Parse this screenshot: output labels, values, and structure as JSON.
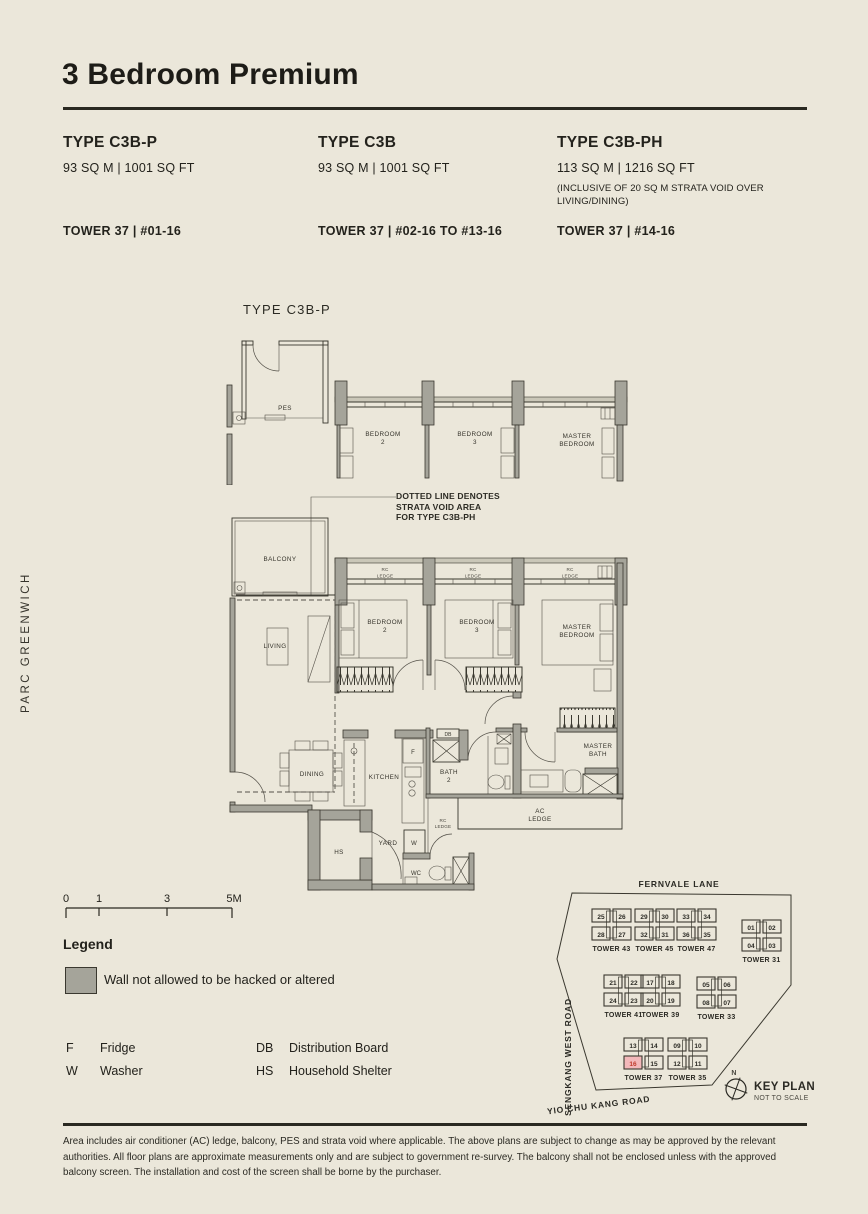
{
  "page": {
    "title": "3 Bedroom Premium",
    "brand_vertical": "PARC GREENWICH",
    "disclaimer": "Area includes air conditioner (AC) ledge, balcony, PES and strata void where applicable. The above plans are subject to change as may be approved by the relevant authorities. All floor plans are approximate measurements only and are subject to government re-survey. The balcony shall not be enclosed unless with the approved balcony screen. The installation and cost of the screen shall be borne by the purchaser."
  },
  "unit_types": [
    {
      "name": "TYPE C3B-P",
      "area": "93 SQ M | 1001 SQ FT",
      "note": "",
      "tower": "TOWER 37 | #01-16"
    },
    {
      "name": "TYPE C3B",
      "area": "93 SQ M | 1001 SQ FT",
      "note": "",
      "tower": "TOWER 37 | #02-16 TO #13-16"
    },
    {
      "name": "TYPE C3B-PH",
      "area": "113 SQ M | 1216 SQ FT",
      "note": "(INCLUSIVE OF 20 SQ M STRATA VOID OVER LIVING/DINING)",
      "tower": "TOWER 37 | #14-16"
    }
  ],
  "plan": {
    "variant_label": "TYPE C3B-P",
    "void_note": [
      "DOTTED LINE DENOTES",
      "STRATA VOID AREA",
      "FOR TYPE C3B-PH"
    ],
    "scale_ticks": [
      "0",
      "1",
      "3",
      "5M"
    ],
    "labels": {
      "pes": "PES",
      "balcony": "BALCONY",
      "living": "LIVING",
      "dining": "DINING",
      "kitchen": "KITCHEN",
      "yard": "YARD",
      "hs": "HS",
      "wc": "WC",
      "w": "W",
      "f": "F",
      "db": "DB",
      "bedroom2": [
        "BEDROOM",
        "2"
      ],
      "bedroom3": [
        "BEDROOM",
        "3"
      ],
      "master_bedroom": [
        "MASTER",
        "BEDROOM"
      ],
      "master_bath": [
        "MASTER",
        "BATH"
      ],
      "bath2": [
        "BATH",
        "2"
      ],
      "ac_ledge": [
        "AC",
        "LEDGE"
      ],
      "rc_ledge": [
        "RC",
        "LEDGE"
      ]
    }
  },
  "legend": {
    "heading": "Legend",
    "wall_note": "Wall not allowed to be hacked or altered",
    "abbreviations": [
      {
        "abbr": "F",
        "label": "Fridge"
      },
      {
        "abbr": "W",
        "label": "Washer"
      },
      {
        "abbr": "DB",
        "label": "Distribution Board"
      },
      {
        "abbr": "HS",
        "label": "Household Shelter"
      }
    ]
  },
  "key_plan": {
    "title": "KEY PLAN",
    "subtitle": "NOT TO SCALE",
    "north": "N",
    "roads": {
      "top": "FERNVALE LANE",
      "left": "SENGKANG WEST ROAD",
      "bottom": "YIO CHU KANG ROAD"
    },
    "highlight_unit": "16",
    "clusters": [
      {
        "label": "TOWER 43",
        "x": 48,
        "y": 37,
        "units": [
          {
            "n": "25"
          },
          {
            "n": "26"
          },
          {
            "n": "28"
          },
          {
            "n": "27"
          }
        ]
      },
      {
        "label": "TOWER 45",
        "x": 91,
        "y": 37,
        "units": [
          {
            "n": "29"
          },
          {
            "n": "30"
          },
          {
            "n": "32"
          },
          {
            "n": "31"
          }
        ]
      },
      {
        "label": "TOWER 47",
        "x": 133,
        "y": 37,
        "units": [
          {
            "n": "33"
          },
          {
            "n": "34"
          },
          {
            "n": "36"
          },
          {
            "n": "35"
          }
        ]
      },
      {
        "label": "TOWER 31",
        "x": 198,
        "y": 48,
        "units": [
          {
            "n": "01"
          },
          {
            "n": "02"
          },
          {
            "n": "04"
          },
          {
            "n": "03"
          }
        ]
      },
      {
        "label": "TOWER 41",
        "x": 60,
        "y": 103,
        "units": [
          {
            "n": "21"
          },
          {
            "n": "22"
          },
          {
            "n": "24"
          },
          {
            "n": "23"
          }
        ]
      },
      {
        "label": "TOWER 39",
        "x": 97,
        "y": 103,
        "units": [
          {
            "n": "17"
          },
          {
            "n": "18"
          },
          {
            "n": "20"
          },
          {
            "n": "19"
          }
        ]
      },
      {
        "label": "TOWER 33",
        "x": 153,
        "y": 105,
        "units": [
          {
            "n": "05"
          },
          {
            "n": "06"
          },
          {
            "n": "08"
          },
          {
            "n": "07"
          }
        ]
      },
      {
        "label": "TOWER 37",
        "x": 80,
        "y": 166,
        "units": [
          {
            "n": "13"
          },
          {
            "n": "14"
          },
          {
            "n": "16",
            "hl": true
          },
          {
            "n": "15"
          }
        ]
      },
      {
        "label": "TOWER 35",
        "x": 124,
        "y": 166,
        "units": [
          {
            "n": "09"
          },
          {
            "n": "10"
          },
          {
            "n": "12"
          },
          {
            "n": "11"
          }
        ]
      }
    ]
  },
  "colors": {
    "background": "#ebe7da",
    "wall": "#a5a49a",
    "line": "#3a382f",
    "highlight_fill": "#f3b8ba",
    "highlight_text": "#c0392b"
  }
}
